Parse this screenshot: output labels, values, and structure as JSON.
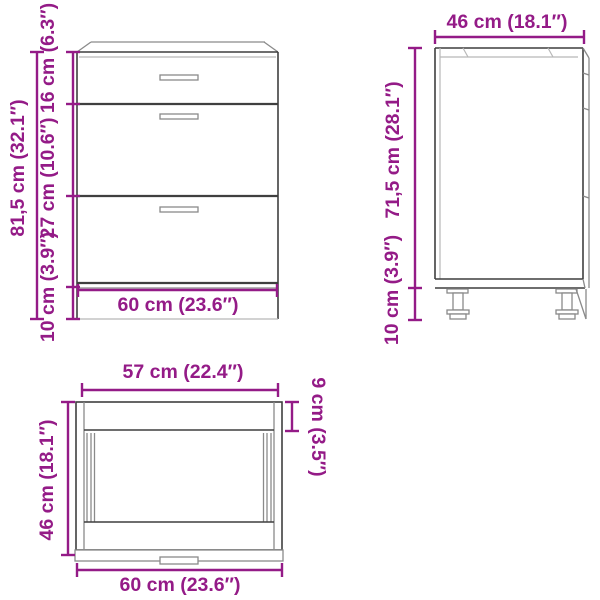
{
  "image": {
    "title": "Cabinet dimensions diagram",
    "background": "#ffffff"
  },
  "colors": {
    "accent": "#941b87",
    "line_dark": "#3f3f3f",
    "line_mid": "#8a8a8a",
    "line_light": "#b8b8b8"
  },
  "views": {
    "front": {
      "total_height": "81,5 cm (32.1″)",
      "top_drawer_height": "16 cm (6.3″)",
      "drawer_height": "27 cm (10.6″)",
      "leg_height": "10 cm (3.9″)",
      "width": "60 cm (23.6″)"
    },
    "side": {
      "depth": "46 cm (18.1″)",
      "body_height": "71,5 cm (28.1″)",
      "leg_height": "10 cm (3.9″)"
    },
    "top": {
      "front_width": "57 cm (22.4″)",
      "depth": "46 cm (18.1″)",
      "back_clearance": "9 cm (3.5″)",
      "total_width": "60 cm (23.6″)"
    }
  }
}
